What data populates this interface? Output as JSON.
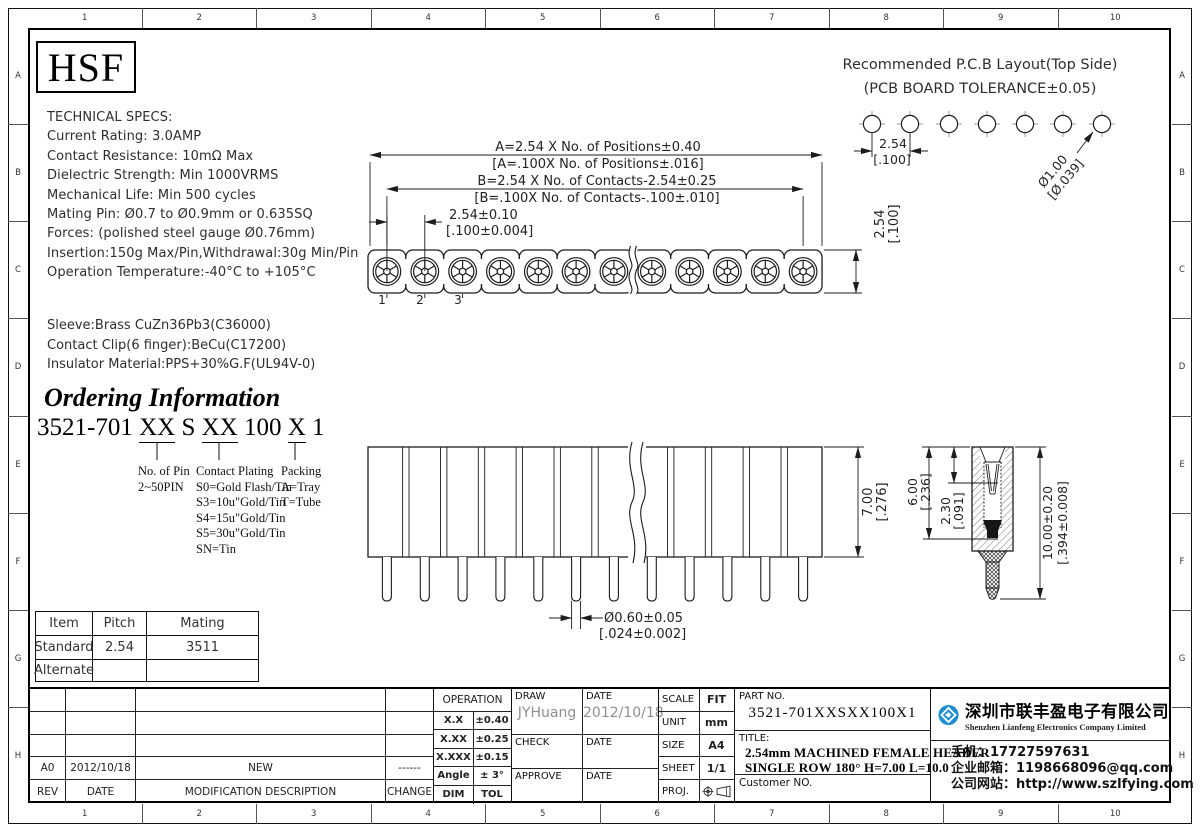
{
  "frame": {
    "columns": [
      "1",
      "2",
      "3",
      "4",
      "5",
      "6",
      "7",
      "8",
      "9",
      "10"
    ],
    "rows": [
      "A",
      "B",
      "C",
      "D",
      "E",
      "F",
      "G",
      "H"
    ]
  },
  "logo": {
    "text": "HSF"
  },
  "tech_specs": {
    "title": "TECHNICAL SPECS:",
    "lines": [
      "Current Rating: 3.0AMP",
      "Contact Resistance: 10mΩ Max",
      "Dielectric Strength: Min 1000VRMS",
      "Mechanical Life: Min 500 cycles",
      "Mating Pin: Ø0.7 to Ø0.9mm or 0.635SQ",
      "Forces: (polished steel gauge Ø0.76mm)",
      "Insertion:150g Max/Pin,Withdrawal:30g Min/Pin",
      "Operation Temperature:-40°C to +105°C"
    ],
    "materials": [
      "Sleeve:Brass CuZn36Pb3(C36000)",
      "Contact Clip(6 finger):BeCu(C17200)",
      "Insulator Material:PPS+30%G.F(UL94V-0)"
    ]
  },
  "ordering": {
    "heading": "Ordering Information",
    "code_parts": [
      "3521-701",
      "XX",
      "S",
      "XX",
      "100",
      "X",
      "1"
    ],
    "pin_label": "No. of Pin",
    "pin_range": "2~50PIN",
    "plating_label": "Contact Plating",
    "plating_options": [
      "S0=Gold Flash/Tin",
      "S3=10u\"Gold/Tin",
      "S4=15u\"Gold/Tin",
      "S5=30u\"Gold/Tin",
      "SN=Tin"
    ],
    "packing_label": "Packing",
    "packing_options": [
      "A=Tray",
      "T=Tube"
    ]
  },
  "pcb_layout": {
    "title1": "Recommended P.C.B Layout(Top Side)",
    "title2": "(PCB BOARD TOLERANCE±0.05)",
    "pitch_mm": "2.54",
    "pitch_in": "[.100]",
    "hole_mm": "Ø1.00",
    "hole_in": "[Ø.039]"
  },
  "dims": {
    "a_mm": "A=2.54 X No. of Positions±0.40",
    "a_in": "[A=.100X No. of Positions±.016]",
    "b_mm": "B=2.54 X No. of Contacts-2.54±0.25",
    "b_in": "[B=.100X No. of Contacts-.100±.010]",
    "pitch_mm": "2.54±0.10",
    "pitch_in": "[.100±0.004]",
    "width_mm": "2.54",
    "width_in": "[.100]",
    "height_mm": "7.00",
    "height_in": "[.276]",
    "depth_mm": "6.00",
    "depth_in": "[.236]",
    "funnel_mm": "2.30",
    "funnel_in": "[.091]",
    "length_mm": "10.00±0.20",
    "length_in": "[.394±0.008]",
    "pin_d_mm": "Ø0.60±0.05",
    "pin_d_in": "[.024±0.002]",
    "pos1": "1",
    "pos2": "2",
    "pos3": "3"
  },
  "mating_table": {
    "headers": [
      "Item",
      "Pitch",
      "Mating"
    ],
    "rows": [
      [
        "Standard",
        "2.54",
        "3511"
      ],
      [
        "Alternate",
        "",
        ""
      ]
    ]
  },
  "title_block": {
    "rev_row": {
      "rev": "A0",
      "date": "2012/10/18",
      "desc": "NEW",
      "change": "------"
    },
    "rev_headers": {
      "rev": "REV",
      "date": "DATE",
      "desc": "MODIFICATION  DESCRIPTION",
      "change": "CHANGE"
    },
    "operation": {
      "header": "OPERATION",
      "rows": [
        [
          "X.X",
          "±0.40"
        ],
        [
          "X.XX",
          "±0.25"
        ],
        [
          "X.XXX",
          "±0.15"
        ],
        [
          "Angle",
          "± 3°"
        ],
        [
          "DIM",
          "TOL"
        ]
      ]
    },
    "sign": {
      "draw_label": "DRAW",
      "draw_name": "JYHuang",
      "draw_date_label": "DATE",
      "draw_date": "2012/10/18",
      "check_label": "CHECK",
      "check_date_label": "DATE",
      "approve_label": "APPROVE",
      "approve_date_label": "DATE"
    },
    "meta": {
      "scale_label": "SCALE",
      "scale": "FIT",
      "unit_label": "UNIT",
      "unit": "mm",
      "size_label": "SIZE",
      "size": "A4",
      "sheet_label": "SHEET",
      "sheet": "1/1",
      "proj_label": "PROJ."
    },
    "part": {
      "part_no_label": "PART NO.",
      "part_no": "3521-701XXSXX100X1",
      "title_label": "TITLE:",
      "title_line1": "2.54mm MACHINED FEMALE HEADER",
      "title_line2": "SINGLE ROW 180° H=7.00 L=10.0",
      "customer_label": "Customer NO."
    },
    "company": {
      "name_cn": "深圳市联丰盈电子有限公司",
      "name_en": "Shenzhen Lianfeng Electronics Company Limited",
      "phone": "手机：17727597631",
      "email": "企业邮箱：1198668096@qq.com",
      "website": "公司网站：http://www.szlfying.com"
    }
  }
}
